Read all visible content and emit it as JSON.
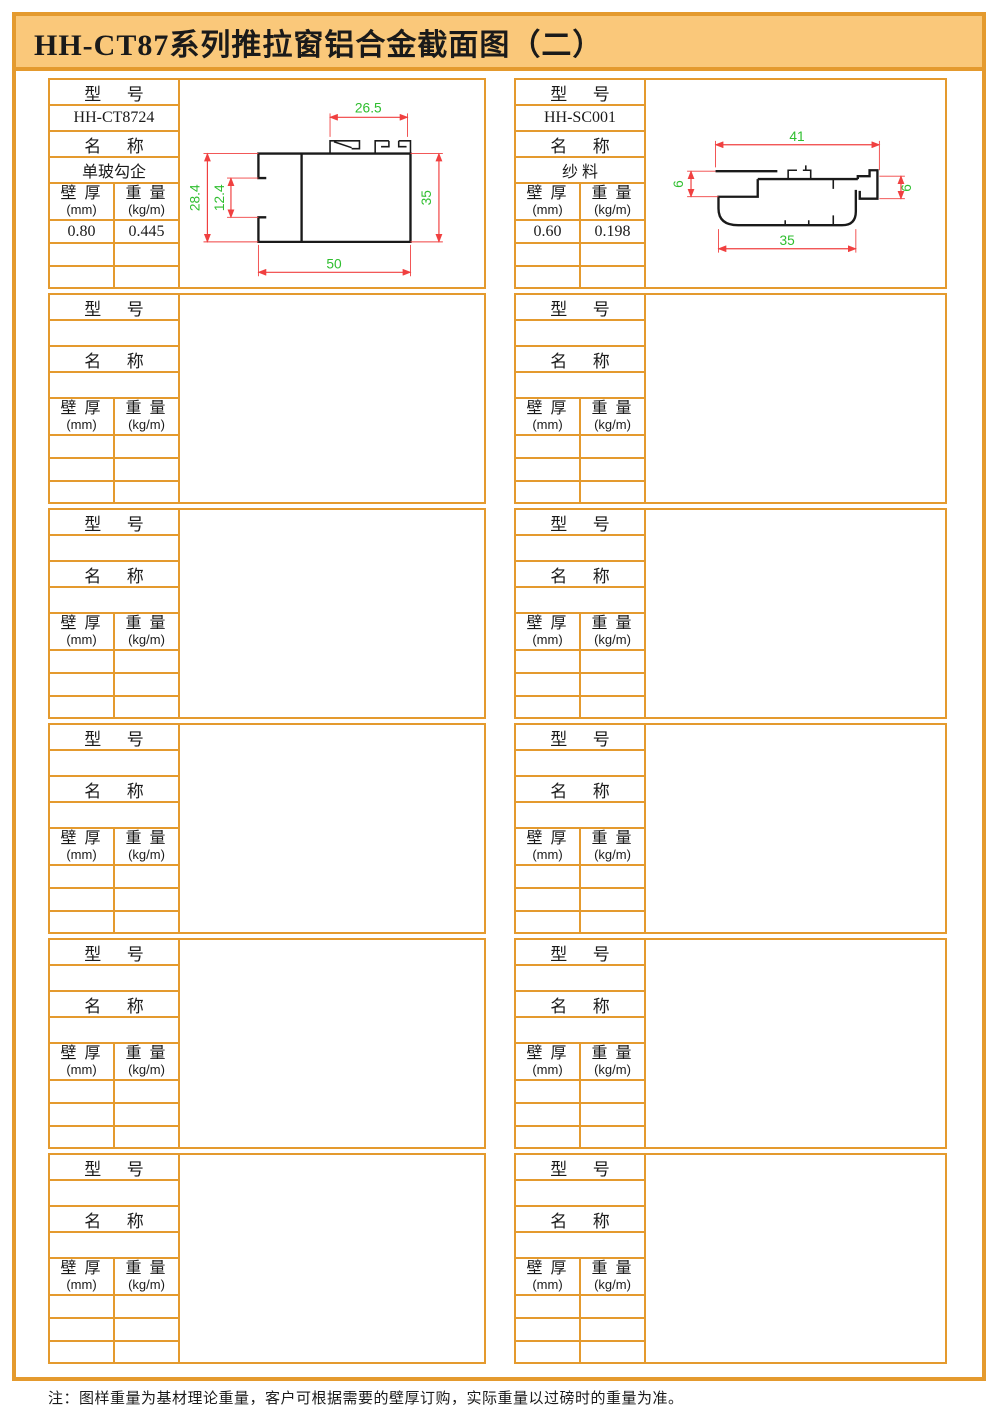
{
  "page": {
    "title": "HH-CT87系列推拉窗铝合金截面图（二）",
    "note": "注：图样重量为基材理论重量，客户可根据需要的壁厚订购，实际重量以过磅时的重量为准。"
  },
  "labels": {
    "model": "型      号",
    "name": "名      称",
    "thickness_title": "壁 厚",
    "thickness_unit": "(mm)",
    "weight_title": "重 量",
    "weight_unit": "(kg/m)"
  },
  "layout": {
    "empty_blocks_per_column": 5
  },
  "colors": {
    "frame_orange": "#E49A2E",
    "title_bg": "#FAC87A",
    "dimension_line_red": "#F04040",
    "dimension_text_green": "#2FBE2F",
    "profile_black": "#1A1A1A"
  },
  "profiles": [
    {
      "model": "HH-CT8724",
      "name": "单玻勾企",
      "wall_thickness_mm": "0.80",
      "weight_kg_per_m": "0.445",
      "dims": {
        "top_width": "26.5",
        "left_height": "28.4",
        "notch_height": "12.4",
        "right_height": "35",
        "bottom_width": "50"
      }
    },
    {
      "model": "HH-SC001",
      "name": "纱 料",
      "wall_thickness_mm": "0.60",
      "weight_kg_per_m": "0.198",
      "dims": {
        "top_width": "41",
        "left_height": "6",
        "right_height": "6",
        "bottom_width": "35"
      }
    }
  ]
}
